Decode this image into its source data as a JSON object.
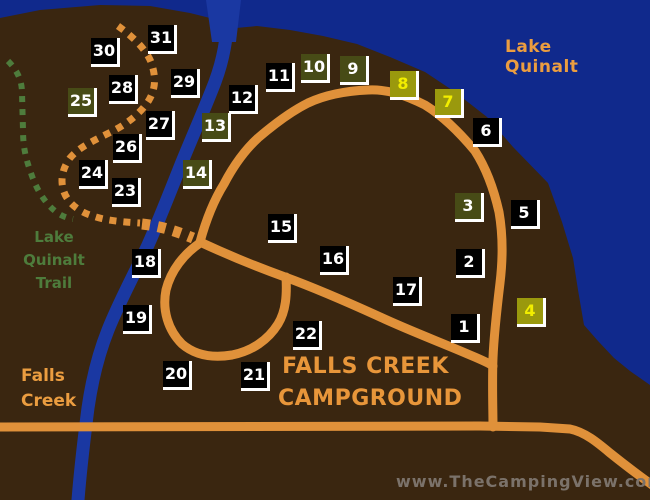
{
  "map": {
    "region_labels": {
      "lake": "Lake Quinalt",
      "trail_line1": "Lake Quinalt",
      "trail_line2": "Trail",
      "creek_line1": "Falls",
      "creek_line2": "Creek"
    },
    "title_line1": "FALLS CREEK",
    "title_line2": "CAMPGROUND",
    "watermark": "www.TheCampingView.com",
    "colors": {
      "water": "#10298c",
      "river": "#1a38a2",
      "land": "#3a2610",
      "road": "#e0913a",
      "trail_orange": "#e0913a",
      "trail_green": "#4e7c3c",
      "label_orange": "#eb9d40",
      "title_orange": "#e8963a",
      "watermark_gray": "#7b726a",
      "site_black_bg": "#000000",
      "site_black_text": "#ffffff",
      "site_olive_bg": "#474b16",
      "site_bright_bg": "#9a990d",
      "site_bright_text": "#f2ee00"
    },
    "sites": [
      {
        "number": "1",
        "variant": "black",
        "x": 451,
        "y": 314
      },
      {
        "number": "2",
        "variant": "black",
        "x": 456,
        "y": 249
      },
      {
        "number": "3",
        "variant": "olive",
        "x": 455,
        "y": 193
      },
      {
        "number": "4",
        "variant": "bright",
        "x": 517,
        "y": 298
      },
      {
        "number": "5",
        "variant": "black",
        "x": 511,
        "y": 200
      },
      {
        "number": "6",
        "variant": "black",
        "x": 473,
        "y": 118
      },
      {
        "number": "7",
        "variant": "bright",
        "x": 435,
        "y": 89
      },
      {
        "number": "8",
        "variant": "bright",
        "x": 390,
        "y": 71
      },
      {
        "number": "9",
        "variant": "olive",
        "x": 340,
        "y": 56
      },
      {
        "number": "10",
        "variant": "olive",
        "x": 301,
        "y": 54
      },
      {
        "number": "11",
        "variant": "black",
        "x": 266,
        "y": 63
      },
      {
        "number": "12",
        "variant": "black",
        "x": 229,
        "y": 85
      },
      {
        "number": "13",
        "variant": "olive",
        "x": 202,
        "y": 113
      },
      {
        "number": "14",
        "variant": "olive",
        "x": 183,
        "y": 160
      },
      {
        "number": "15",
        "variant": "black",
        "x": 268,
        "y": 214
      },
      {
        "number": "16",
        "variant": "black",
        "x": 320,
        "y": 246
      },
      {
        "number": "17",
        "variant": "black",
        "x": 393,
        "y": 277
      },
      {
        "number": "18",
        "variant": "black",
        "x": 132,
        "y": 249
      },
      {
        "number": "19",
        "variant": "black",
        "x": 123,
        "y": 305
      },
      {
        "number": "20",
        "variant": "black",
        "x": 163,
        "y": 361
      },
      {
        "number": "21",
        "variant": "black",
        "x": 241,
        "y": 362
      },
      {
        "number": "22",
        "variant": "black",
        "x": 293,
        "y": 321
      },
      {
        "number": "23",
        "variant": "black",
        "x": 112,
        "y": 178
      },
      {
        "number": "24",
        "variant": "black",
        "x": 79,
        "y": 160
      },
      {
        "number": "25",
        "variant": "olive",
        "x": 68,
        "y": 88
      },
      {
        "number": "26",
        "variant": "black",
        "x": 113,
        "y": 134
      },
      {
        "number": "27",
        "variant": "black",
        "x": 146,
        "y": 111
      },
      {
        "number": "28",
        "variant": "black",
        "x": 109,
        "y": 75
      },
      {
        "number": "29",
        "variant": "black",
        "x": 171,
        "y": 69
      },
      {
        "number": "30",
        "variant": "black",
        "x": 91,
        "y": 38
      },
      {
        "number": "31",
        "variant": "black",
        "x": 148,
        "y": 25
      }
    ]
  }
}
